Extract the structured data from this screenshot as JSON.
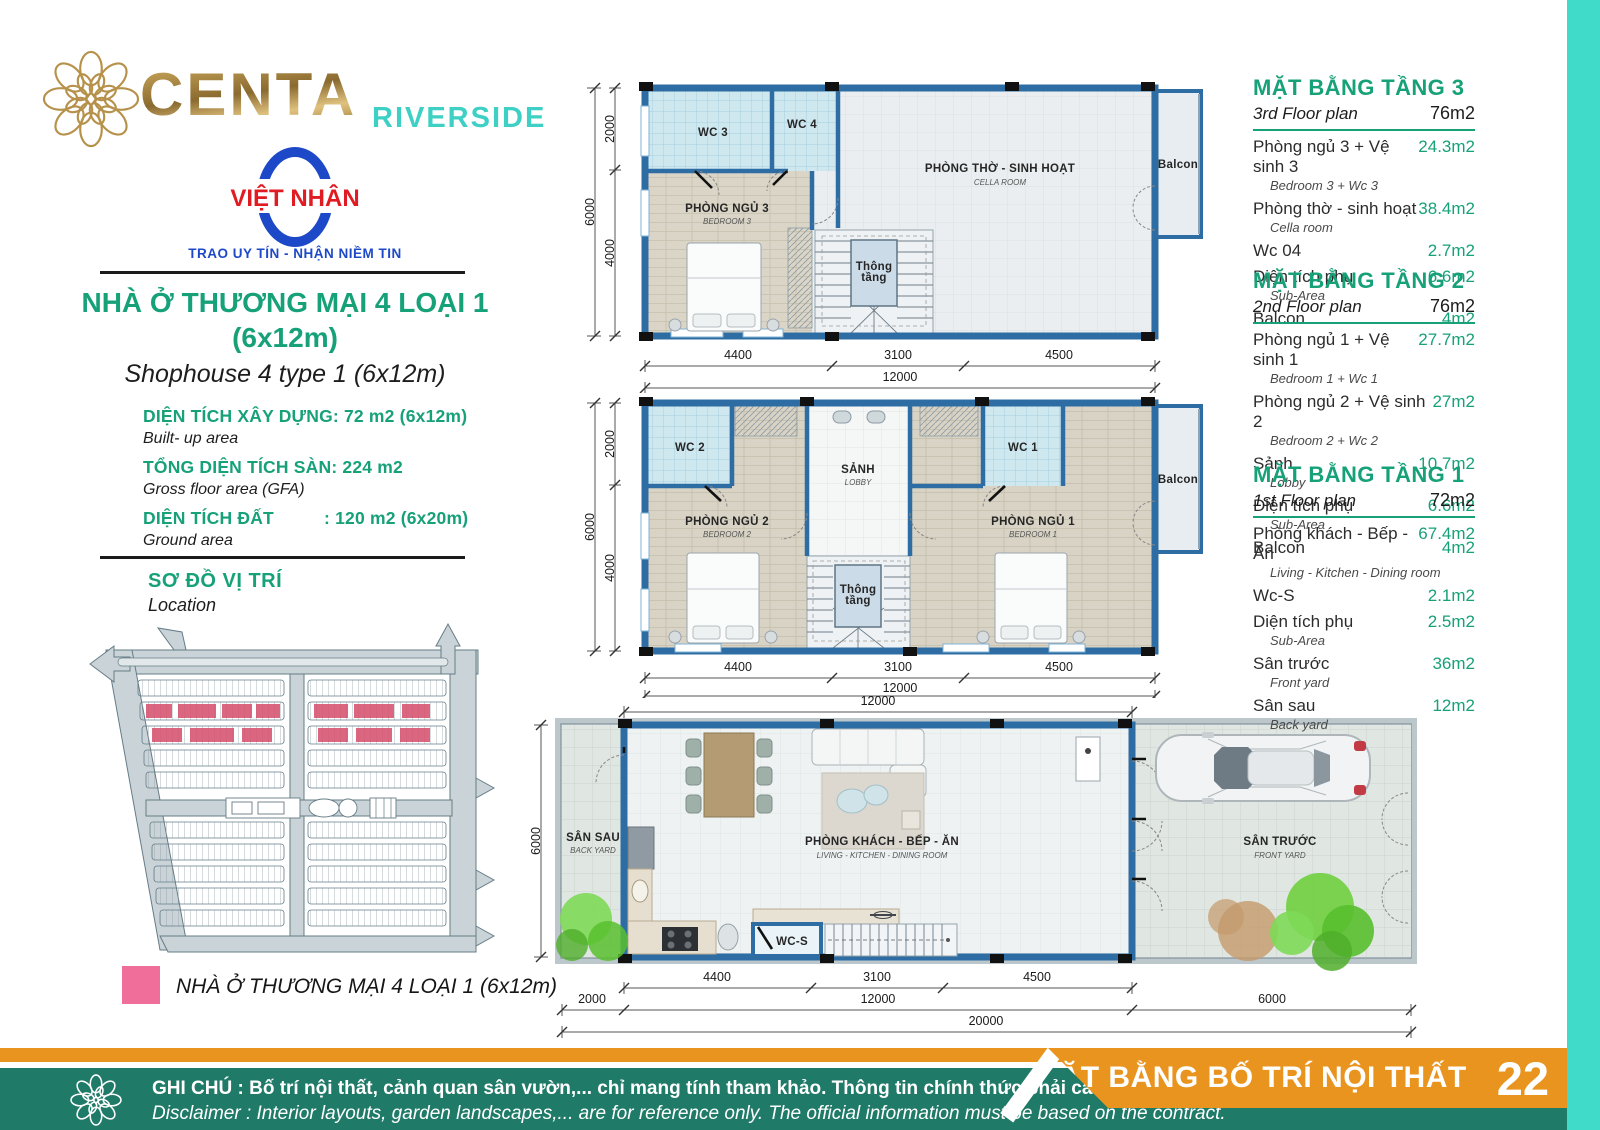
{
  "brand": {
    "name": "CENTA",
    "suffix": "RIVERSIDE",
    "developer": "VIỆT NHÂN",
    "tagline": "TRAO UY TÍN - NHẬN NIỀM TIN"
  },
  "product": {
    "title": "NHÀ Ở THƯƠNG MẠI 4 LOẠI 1",
    "title_size": "(6x12m)",
    "subtitle": "Shophouse 4 type 1 (6x12m)",
    "specs": [
      {
        "name": "DIỆN TÍCH XÂY DỰNG",
        "value": ": 72 m2 (6x12m)",
        "sub": "Built- up area"
      },
      {
        "name": "TỔNG DIỆN TÍCH SÀN",
        "value": ": 224 m2",
        "sub": "Gross floor area (GFA)"
      },
      {
        "name": "DIỆN TÍCH ĐẤT",
        "value": ": 120 m2 (6x20m)",
        "sub": "Ground area"
      }
    ]
  },
  "location": {
    "title": "SƠ ĐỒ VỊ TRÍ",
    "subtitle": "Location"
  },
  "legend": {
    "label": "NHÀ Ở THƯƠNG MẠI 4 LOẠI 1 (6x12m)",
    "color": "#ef6f9a"
  },
  "tables": [
    {
      "title": "MẶT BẰNG TẦNG 3",
      "subtitle": "3rd Floor plan",
      "total": "76m2",
      "rows": [
        {
          "vi": "Phòng ngủ 3 + Vệ sinh 3",
          "en": "Bedroom 3 + Wc 3",
          "value": "24.3m2"
        },
        {
          "vi": "Phòng thờ - sinh hoạt",
          "en": "Cella room",
          "value": "38.4m2"
        },
        {
          "vi": "Wc 04",
          "en": "",
          "value": "2.7m2"
        },
        {
          "vi": "Diện tích phụ",
          "en": "Sub-Area",
          "value": "6.6m2"
        },
        {
          "vi": "Balcon",
          "en": "",
          "value": "4m2"
        }
      ]
    },
    {
      "title": "MẶT BẰNG TẦNG 2",
      "subtitle": "2nd Floor plan",
      "total": "76m2",
      "rows": [
        {
          "vi": "Phòng ngủ 1 + Vệ sinh 1",
          "en": "Bedroom 1 + Wc 1",
          "value": "27.7m2"
        },
        {
          "vi": "Phòng ngủ 2 + Vệ sinh 2",
          "en": "Bedroom 2 + Wc 2",
          "value": "27m2"
        },
        {
          "vi": "Sảnh",
          "en": "Lobby",
          "value": "10.7m2"
        },
        {
          "vi": "Diện tích phụ",
          "en": "Sub-Area",
          "value": "6.6m2"
        },
        {
          "vi": "Balcon",
          "en": "",
          "value": "4m2"
        }
      ]
    },
    {
      "title": "MẶT BẰNG TẦNG 1",
      "subtitle": "1st Floor plan",
      "total": "72m2",
      "rows": [
        {
          "vi": "Phòng khách - Bếp - Ăn",
          "en": "Living - Kitchen - Dining room",
          "value": "67.4m2"
        },
        {
          "vi": "Wc-S",
          "en": "",
          "value": "2.1m2"
        },
        {
          "vi": "Diện tích phụ",
          "en": "Sub-Area",
          "value": "2.5m2"
        },
        {
          "vi": "Sân trước",
          "en": "Front yard",
          "value": "36m2"
        },
        {
          "vi": "Sân sau",
          "en": "Back yard",
          "value": "12m2"
        }
      ]
    }
  ],
  "plans": {
    "floor3": {
      "wc3": "WC 3",
      "wc4": "WC 4",
      "bedroom": "PHÒNG NGỦ 3",
      "bedroom_en": "BEDROOM 3",
      "cella": "PHÒNG THỜ - SINH HOẠT",
      "cella_en": "CELLA ROOM",
      "void_l1": "Thông",
      "void_l2": "tầng",
      "balcony": "Balcon",
      "dim_left_total": "6000",
      "dim_left_top": "2000",
      "dim_left_bottom": "4000",
      "dim_b1": "4400",
      "dim_b2": "3100",
      "dim_b3": "4500",
      "dim_total": "12000"
    },
    "floor2": {
      "wc2": "WC 2",
      "wc1": "WC 1",
      "lobby": "SẢNH",
      "lobby_en": "LOBBY",
      "bedroom2": "PHÒNG NGỦ 2",
      "bedroom2_en": "BEDROOM 2",
      "bedroom1": "PHÒNG NGỦ 1",
      "bedroom1_en": "BEDROOM 1",
      "void_l1": "Thông",
      "void_l2": "tầng",
      "balcony": "Balcon",
      "dim_left_total": "6000",
      "dim_left_top": "2000",
      "dim_left_bottom": "4000",
      "dim_b1": "4400",
      "dim_b2": "3100",
      "dim_b3": "4500",
      "dim_total": "12000"
    },
    "floor1": {
      "backyard": "SÂN SAU",
      "backyard_en": "BACK YARD",
      "living": "PHÒNG KHÁCH - BẾP - ĂN",
      "living_en": "LIVING - KITCHEN - DINING ROOM",
      "wc": "WC-S",
      "frontyard": "SÂN TRƯỚC",
      "frontyard_en": "FRONT YARD",
      "dim_top": "12000",
      "dim_left": "6000",
      "dim_b1": "4400",
      "dim_b2": "3100",
      "dim_b3": "4500",
      "dim_r2a": "2000",
      "dim_r2b": "12000",
      "dim_r2c": "6000",
      "dim_total": "20000"
    }
  },
  "footer": {
    "note_vi": "GHI CHÚ : Bố trí nội thất, cảnh quan sân vườn,... chỉ mang tính tham khảo. Thông tin chính thức phải căn cứ theo hợp đồng.",
    "note_en": "Disclaimer : Interior layouts, garden landscapes,... are for reference only. The official information must be based on the contract.",
    "banner": "MẶT BẰNG BỐ TRÍ NỘI THẤT",
    "page": "22"
  }
}
